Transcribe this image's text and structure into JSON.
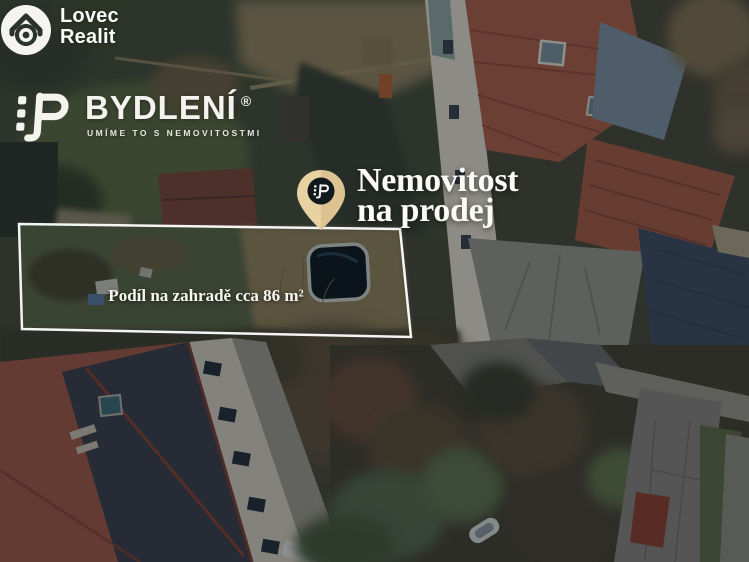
{
  "branding": {
    "agency_logo": {
      "line1": "Lovec",
      "line2": "Realit",
      "icon": "house-scope-icon"
    },
    "company_logo": {
      "name": "BYDLENÍ",
      "registered_mark": "®",
      "tagline": "UMÍME TO S NEMOVITOSTMI",
      "icon": "bydleni-block-icon"
    }
  },
  "badge": {
    "icon": "location-pin-icon",
    "line1": "Nemovitost",
    "line2": "na prodej"
  },
  "parcel": {
    "area_label": "Podíl na zahradě cca 86 m²",
    "boundary": "white outlined quadrilateral around garden share"
  },
  "colors": {
    "pin_fill": "#e7d2a2",
    "pin_inner": "#11191f",
    "boundary_stroke": "#ffffff",
    "text_light": "#fafaf7"
  }
}
